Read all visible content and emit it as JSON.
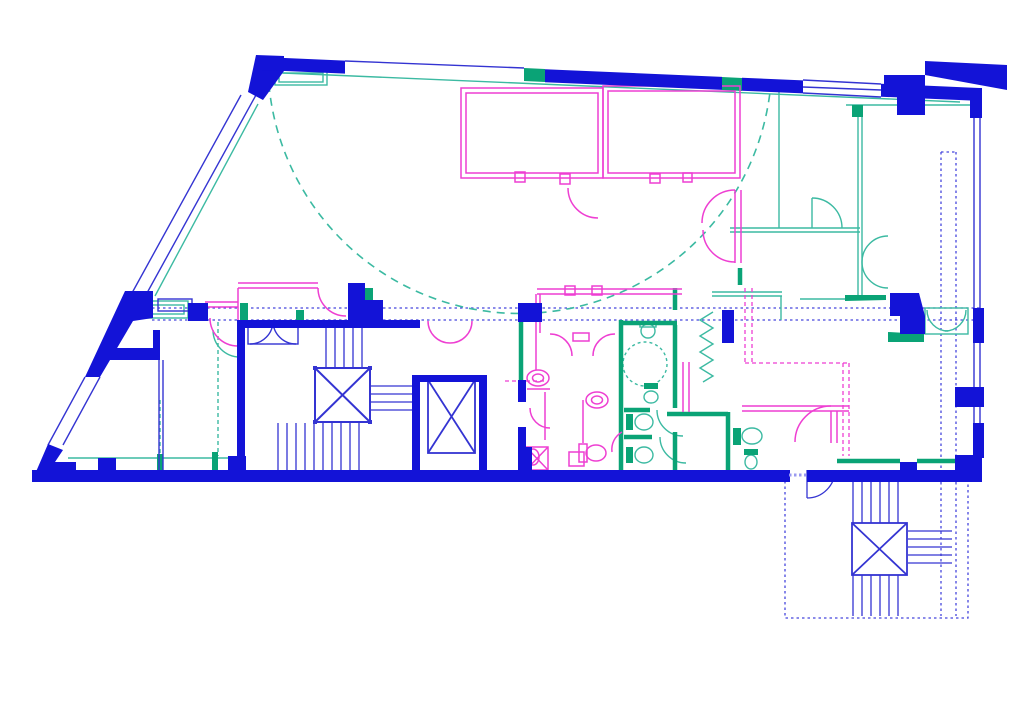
{
  "document": {
    "type": "architectural-floor-plan",
    "visible_text": "",
    "background": "#ffffff"
  },
  "canvas": {
    "width": 1024,
    "height": 724
  },
  "layers": {
    "structural_wall": {
      "label": "structural walls / columns",
      "color": "#1313d7"
    },
    "partition_blue": {
      "label": "thin partitions / windows / stairs",
      "color": "#3434d2"
    },
    "axis_dotted": {
      "label": "reference axes (dotted)",
      "color": "#4646dd"
    },
    "interior_magenta": {
      "label": "interior fit-out & sanitary (magenta)",
      "color": "#ee3fd2"
    },
    "services_teal": {
      "label": "secondary partitions / doors (teal)",
      "color": "#3cbaa2"
    },
    "services_dark": {
      "label": "wet-core walls / fills (green)",
      "color": "#0aa376"
    },
    "threshold_dash": {
      "label": "door threshold dashes",
      "color": "#9a9af0"
    },
    "paper_white": {
      "label": "paper / room background",
      "color": "#ffffff"
    }
  },
  "features": {
    "perimeter": [
      "sloped-top-wall",
      "glazed-diagonal-wall",
      "bottom-wall",
      "glazed-right-wall"
    ],
    "circulation": [
      "large-dashed-swing-arc",
      "double-axis-corridor-line",
      "stair-core-upper",
      "elevator-shaft-a",
      "elevator-shaft-b",
      "external-stair-core",
      "elevator-shaft-c"
    ],
    "rooms": [
      "top-meeting-rooms-magenta",
      "right-teal-rooms",
      "left-rooms",
      "sanitary-block-magenta",
      "wet-core-teal"
    ],
    "fixtures": [
      "wash-basins",
      "toilets",
      "accessible-turning-circle",
      "shower-cross",
      "door-swings"
    ],
    "counts": {
      "elevator_x_boxes": 3,
      "green_wall_markers": 6
    }
  }
}
